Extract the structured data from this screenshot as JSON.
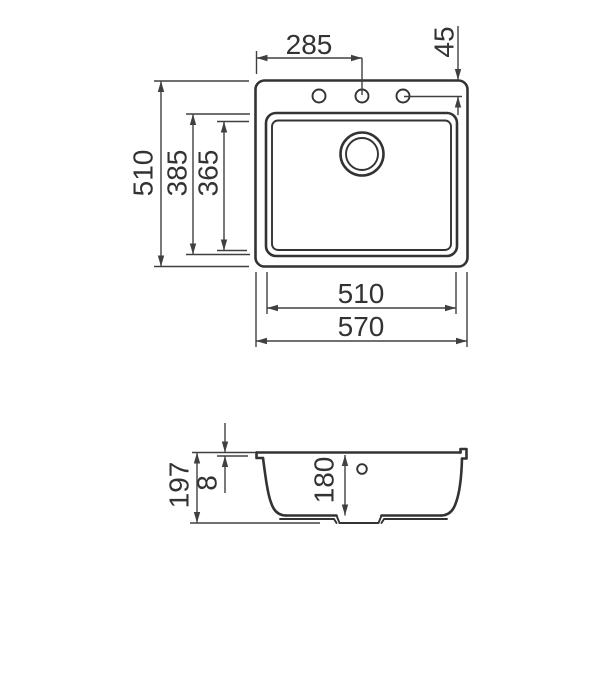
{
  "figure": {
    "kind": "sink technical drawing",
    "background_color": "#ffffff",
    "line_color": "#333333",
    "dimension_line_color": "#404040"
  },
  "top_view": {
    "dims": {
      "faucet_center_from_left": "285",
      "faucet_offset_from_top": "45",
      "overall_depth": "510",
      "bowl_outer_depth": "385",
      "bowl_inner_depth": "365",
      "bowl_width": "510",
      "overall_width": "570"
    }
  },
  "section_view": {
    "dims": {
      "overall_height": "197",
      "rim_thickness": "8",
      "bowl_depth": "180"
    }
  }
}
